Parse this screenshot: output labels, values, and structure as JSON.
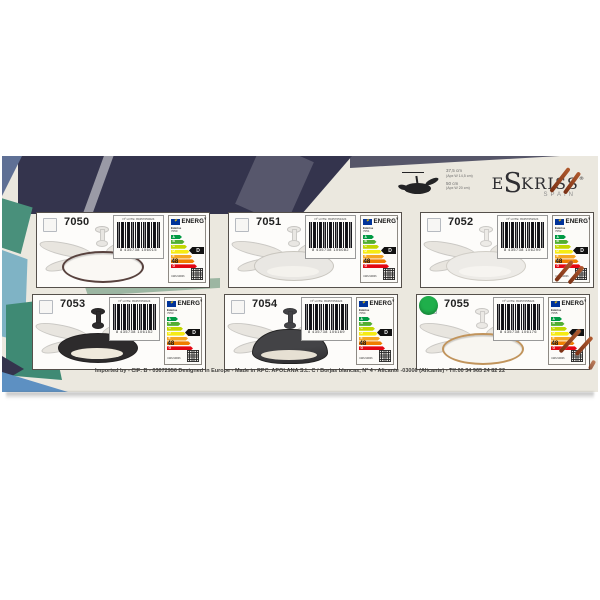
{
  "brand": {
    "pre": "E",
    "mid": "S",
    "post": "KRISS",
    "reg": "®",
    "country": "SPAIN"
  },
  "dimensions": {
    "h1": "37,5 cm",
    "h1b": "(Apx W 14,5 cm)",
    "h2": "50 cm",
    "h2b": "(Apx W 20 cm)"
  },
  "footer": "Imported by - CIF: B - 03072956 Designed in Europe - Made in RPC.  APOLANA S.L. C / Borjas blancas, Nº 4 - Alicante -03006 (Alicante) - Tlf:00 34 965 24 82 22",
  "energy_label": {
    "header": "ENERG",
    "header_sup": "Y",
    "brand": "Eskriss",
    "kwh_unit": "kWh/1000h",
    "classes": [
      "A",
      "B",
      "C",
      "D",
      "E",
      "F",
      "G"
    ],
    "colors": [
      "#009a44",
      "#52ae32",
      "#c3d600",
      "#f6eb14",
      "#f5a623",
      "#ef7d00",
      "#e30613"
    ],
    "widths": [
      11,
      13.5,
      16,
      18.5,
      21,
      23.5,
      26
    ]
  },
  "box_colors": {
    "cream": "#ebe8df",
    "navy": "#34344d",
    "navy_light": "#3c3c55",
    "slate": "#5f7095",
    "teal": "#49907b",
    "teal_dark": "#3f8a74",
    "light_blue": "#7fb3c5",
    "sage": "#9cb6a2",
    "blue": "#5d90c2"
  },
  "products": [
    {
      "model": "7050",
      "lot": "Nº LOTE: 80457050024",
      "ean": "8 435738 106015",
      "rating": "D",
      "kwh": "48",
      "fan": {
        "shape": "halo",
        "body": "#e8e6e2",
        "ring": "#58423e",
        "light": "#faf8f4"
      }
    },
    {
      "model": "7051",
      "lot": "Nº LOTE: 80457051024",
      "ean": "8 435738 106082",
      "rating": "D",
      "kwh": "48",
      "fan": {
        "shape": "drum",
        "body": "#e9e7e3",
        "ring": "#c8c5be",
        "light": "#f4f2ed"
      }
    },
    {
      "model": "7052",
      "lot": "Nº LOTE: 80457052024",
      "ean": "8 435738 106299",
      "rating": "D",
      "kwh": "48",
      "fan": {
        "shape": "drum",
        "body": "#edebe7",
        "ring": "#d0cdc6",
        "light": "#f6f4f0"
      }
    },
    {
      "model": "7053",
      "lot": "Nº LOTE: 80457053024",
      "ean": "8 435738 106152",
      "rating": "D",
      "kwh": "48",
      "fan": {
        "shape": "drum",
        "body": "#2d2b2c",
        "ring": "#232122",
        "light": "#efe9dc"
      }
    },
    {
      "model": "7054",
      "lot": "Nº LOTE: 80457054024",
      "ean": "8 435738 106169",
      "rating": "D",
      "kwh": "48",
      "fan": {
        "shape": "dome",
        "body": "#434346",
        "ring": "#343336",
        "light": "#e6e0d3"
      }
    },
    {
      "model": "7055",
      "lot": "Nº LOTE: 80457055024",
      "ean": "8 435738 106176",
      "rating": "D",
      "kwh": "48",
      "sticker_color": "#1faf4b",
      "fan": {
        "shape": "halo",
        "body": "#ebe9e5",
        "ring": "#c1945c",
        "light": "#f8f6f1"
      }
    }
  ]
}
